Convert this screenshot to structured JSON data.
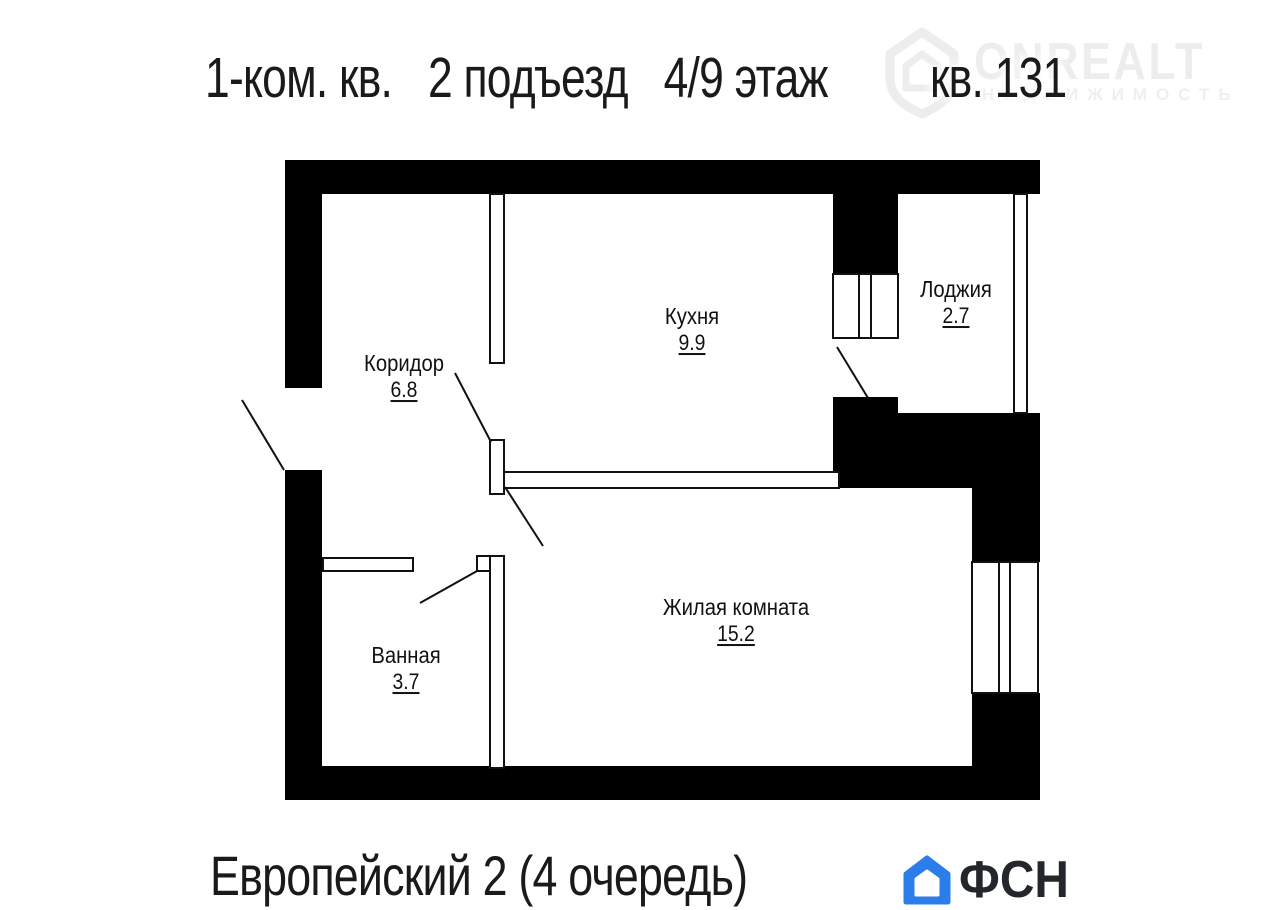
{
  "header": {
    "unit_type": "1-ком. кв.",
    "entrance": "2 подъезд",
    "floor": "4/9 этаж",
    "apartment": "кв. 131"
  },
  "watermark": {
    "brand": "ONREALT",
    "tagline": "НЕДВИЖИМОСТЬ",
    "icon": "house-pin-icon",
    "color": "#efecec"
  },
  "rooms": [
    {
      "name": "Кухня",
      "area": "9.9"
    },
    {
      "name": "Лоджия",
      "area": "2.7"
    },
    {
      "name": "Коридор",
      "area": "6.8"
    },
    {
      "name": "Ванная",
      "area": "3.7"
    },
    {
      "name": "Жилая комната",
      "area": "15.2"
    }
  ],
  "footer": {
    "complex": "Европейский 2 (4 очередь)",
    "developer": "ФСН"
  },
  "colors": {
    "walls": "#000000",
    "background": "#ffffff",
    "developer_accent": "#2b7de9",
    "developer_text": "#23262b",
    "watermark": "#efecec"
  }
}
